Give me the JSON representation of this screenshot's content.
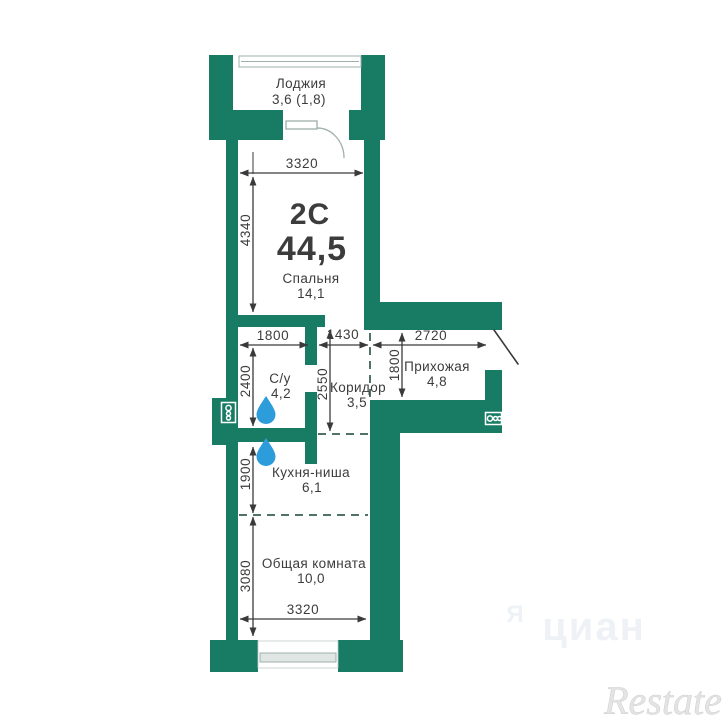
{
  "colors": {
    "wall": "#187b64",
    "drop": "#2D9CDB",
    "dash": "#4f7467",
    "line": "#3a3a3a",
    "text": "#3c3c3c",
    "watermark": "#e4e4e4",
    "watermark_faint": "#eef2f6"
  },
  "plan": {
    "type": "2С",
    "total_area": "44,5"
  },
  "rooms": {
    "loggia": {
      "name": "Лоджия",
      "area": "3,6 (1,8)"
    },
    "bedroom": {
      "name": "Спальня",
      "area": "14,1"
    },
    "bathroom": {
      "name": "С/у",
      "area": "4,2"
    },
    "corridor": {
      "name": "Коридор",
      "area": "3,5"
    },
    "hallway": {
      "name": "Прихожая",
      "area": "4,8"
    },
    "kitchen": {
      "name": "Кухня-ниша",
      "area": "6,1"
    },
    "living": {
      "name": "Общая комната",
      "area": "10,0"
    }
  },
  "dimensions_mm": {
    "bedroom_width": "3320",
    "bedroom_height": "4340",
    "bathroom_width": "1800",
    "corridor_width": "1430",
    "hallway_width": "2720",
    "bathroom_height": "2400",
    "corridor_height": "2550",
    "hallway_height": "1800",
    "kitchen_height": "1900",
    "living_height": "3080",
    "living_width": "3320"
  },
  "icons": {
    "water_drop": "water-drop-icon",
    "vent_left": "vent-shaft-icon",
    "vent_right": "vent-shaft-icon"
  },
  "watermarks": {
    "brand": "Restate",
    "faint_letter": "Я",
    "faint_word": "циан"
  }
}
